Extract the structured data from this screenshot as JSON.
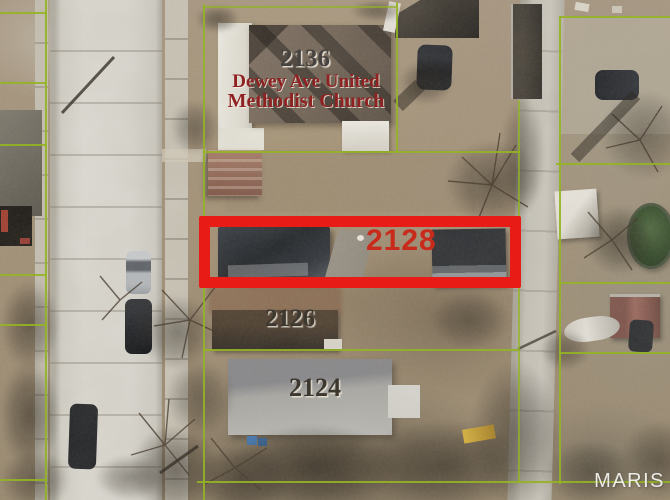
{
  "map": {
    "type": "aerial-parcel-map",
    "labels": {
      "church_number": "2136",
      "church_name_line1": "Dewey Ave United",
      "church_name_line2": "Methodist Church",
      "highlight_number": "2128",
      "house_2126": "2126",
      "house_2124": "2124"
    },
    "watermark": "MARIS",
    "colors": {
      "parcel_line": "#93b424",
      "highlight_box": "#e81b17",
      "highlight_number_text": "#c82a1c",
      "church_name_text": "#8e2222",
      "address_text": "#3c372f",
      "watermark_text": "#f0efeb"
    }
  }
}
